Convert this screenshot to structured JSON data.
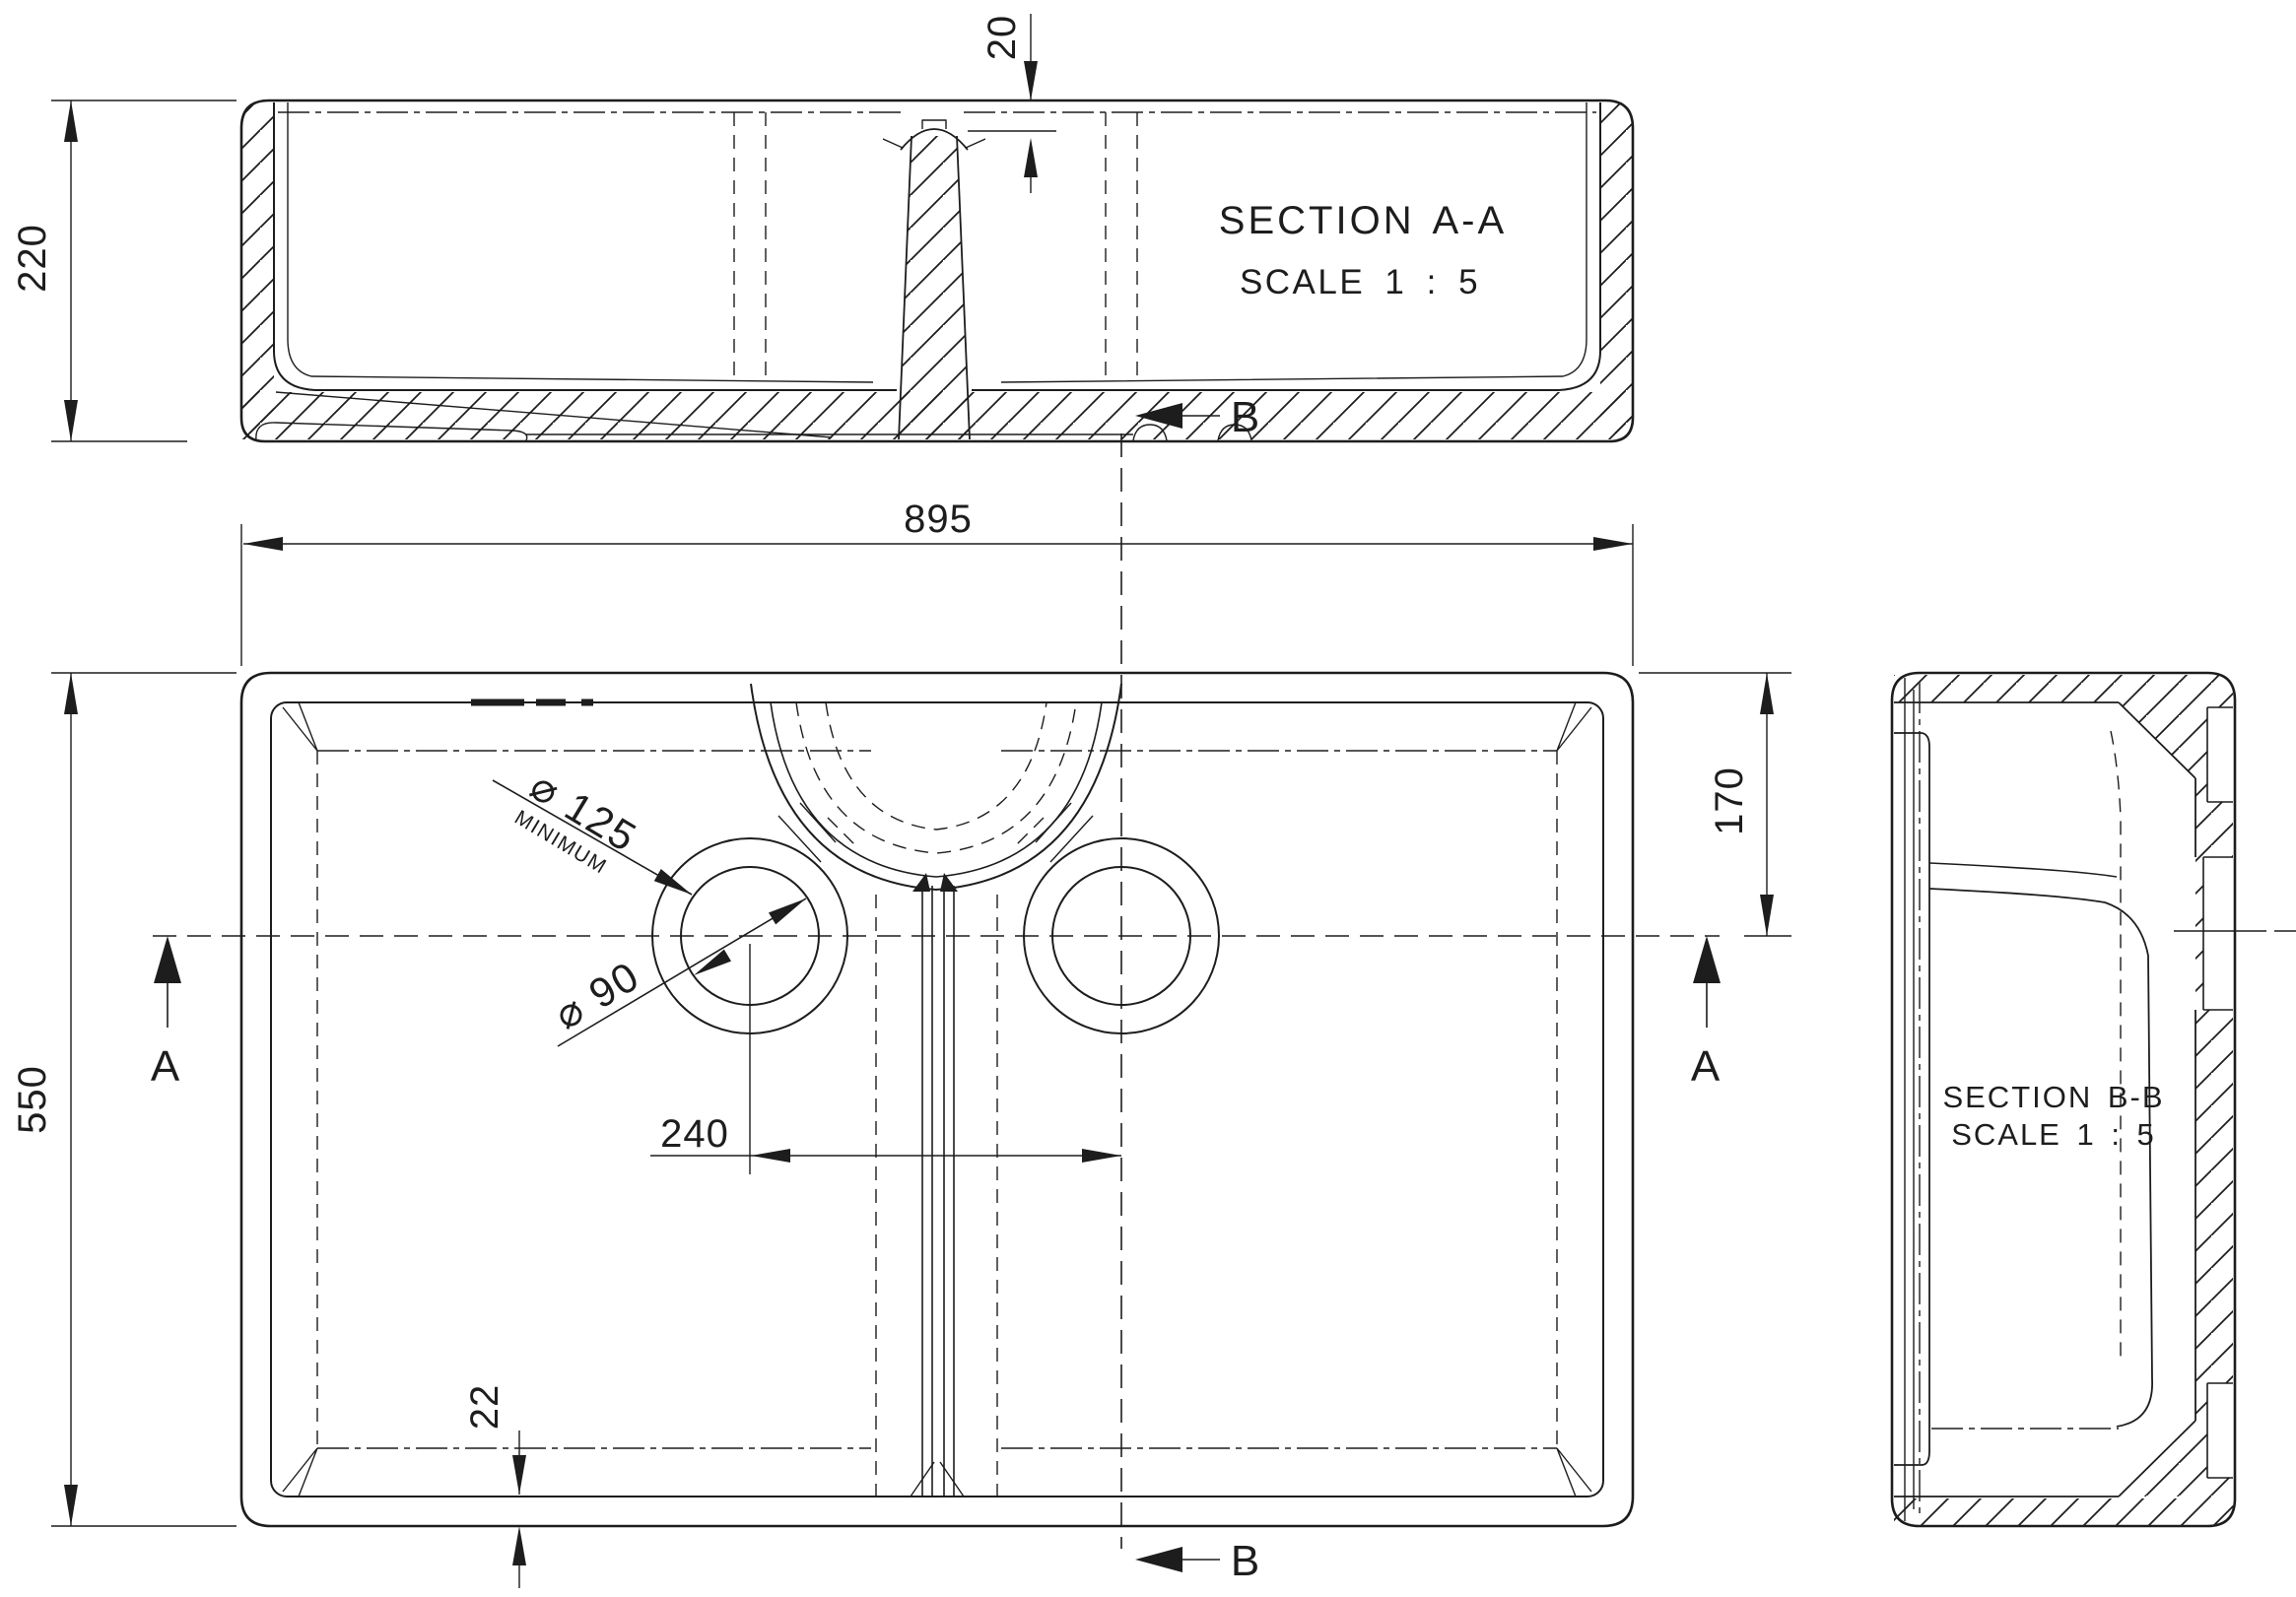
{
  "page": {
    "background": "#ffffff",
    "line_color": "#1d1d1d"
  },
  "views": {
    "section_aa": {
      "title": "SECTION A-A",
      "scale": "SCALE 1 : 5"
    },
    "section_bb": {
      "title": "SECTION B-B",
      "scale": "SCALE 1 : 5"
    }
  },
  "dimensions": {
    "overall_height": "220",
    "divider_step": "20",
    "overall_width": "895",
    "overall_depth": "550",
    "centerline_offset": "170",
    "waste_centres": "240",
    "base_wall": "22",
    "min_cutout_dia": "⌀ 125",
    "min_cutout_note": "MINIMUM",
    "waste_dia": "⌀ 90"
  },
  "section_marks": {
    "a": "A",
    "b": "B"
  }
}
